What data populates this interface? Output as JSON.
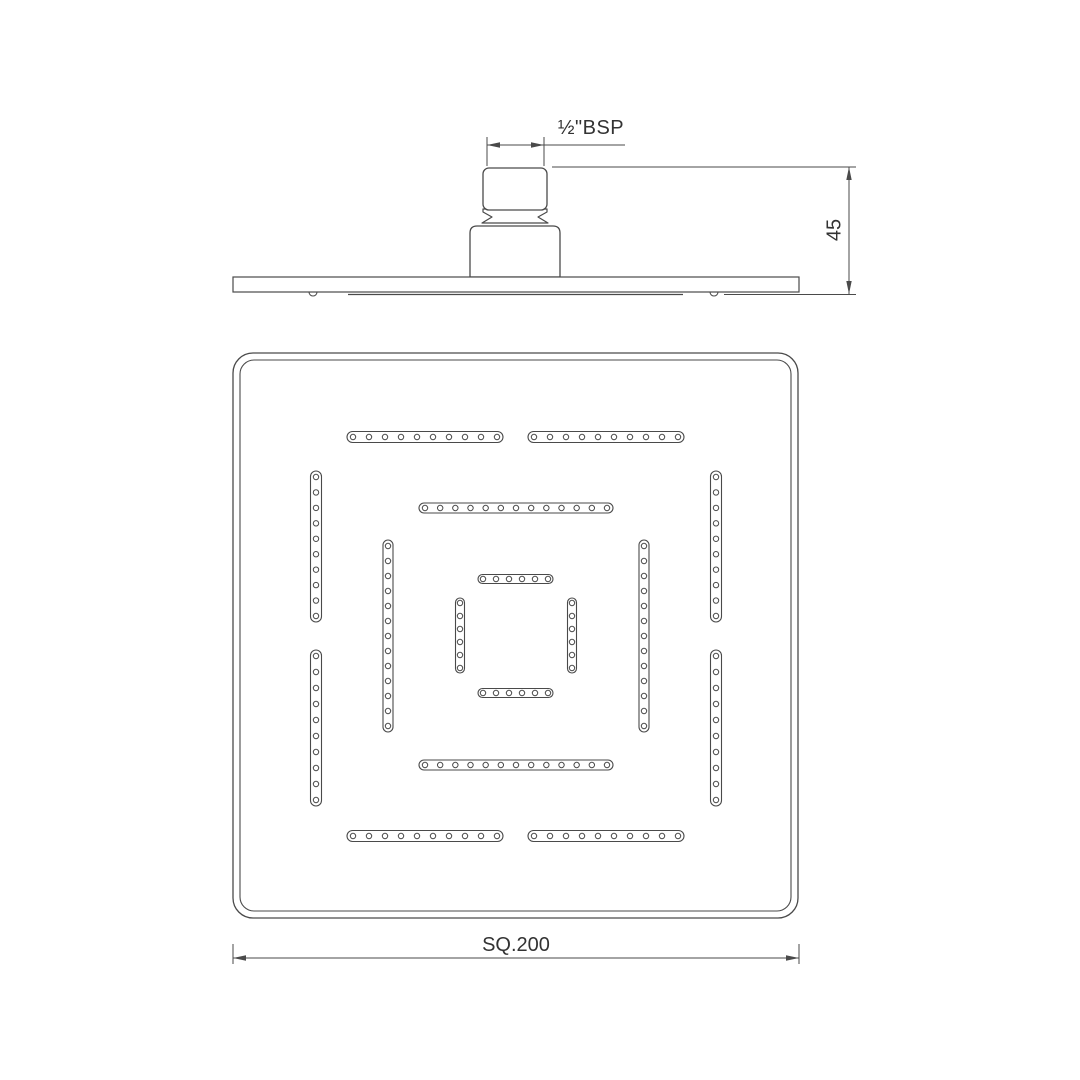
{
  "labels": {
    "thread_size": "½\"BSP",
    "head_height": "45",
    "head_size": "SQ.200"
  },
  "drawing": {
    "line_color": "#4a4a4a",
    "background": "#ffffff",
    "bottom_view": {
      "outer": {
        "x": 233,
        "y": 353,
        "size": 565,
        "r": 20
      },
      "inner": {
        "x": 240,
        "y": 360,
        "size": 551,
        "r": 14
      }
    },
    "slots": [
      {
        "t": "h",
        "a1": 347,
        "a2": 503,
        "c": 437,
        "w": 11,
        "n": 10
      },
      {
        "t": "h",
        "a1": 528,
        "a2": 684,
        "c": 437,
        "w": 11,
        "n": 10
      },
      {
        "t": "h",
        "a1": 347,
        "a2": 503,
        "c": 836,
        "w": 11,
        "n": 10
      },
      {
        "t": "h",
        "a1": 528,
        "a2": 684,
        "c": 836,
        "w": 11,
        "n": 10
      },
      {
        "t": "v",
        "a1": 471,
        "a2": 622,
        "c": 316,
        "w": 11,
        "n": 10
      },
      {
        "t": "v",
        "a1": 650,
        "a2": 806,
        "c": 316,
        "w": 11,
        "n": 10
      },
      {
        "t": "v",
        "a1": 471,
        "a2": 622,
        "c": 716,
        "w": 11,
        "n": 10
      },
      {
        "t": "v",
        "a1": 650,
        "a2": 806,
        "c": 716,
        "w": 11,
        "n": 10
      },
      {
        "t": "h",
        "a1": 419,
        "a2": 613,
        "c": 508,
        "w": 10,
        "n": 13
      },
      {
        "t": "h",
        "a1": 419,
        "a2": 613,
        "c": 765,
        "w": 10,
        "n": 13
      },
      {
        "t": "v",
        "a1": 540,
        "a2": 732,
        "c": 388,
        "w": 10,
        "n": 13
      },
      {
        "t": "v",
        "a1": 540,
        "a2": 732,
        "c": 644,
        "w": 10,
        "n": 13
      },
      {
        "t": "h",
        "a1": 478,
        "a2": 553,
        "c": 579,
        "w": 9,
        "n": 6
      },
      {
        "t": "h",
        "a1": 478,
        "a2": 553,
        "c": 693,
        "w": 9,
        "n": 6
      },
      {
        "t": "v",
        "a1": 598,
        "a2": 673,
        "c": 460,
        "w": 9,
        "n": 6
      },
      {
        "t": "v",
        "a1": 598,
        "a2": 673,
        "c": 572,
        "w": 9,
        "n": 6
      }
    ],
    "side_view": {
      "plate": {
        "x1": 233,
        "x2": 799,
        "y1": 277,
        "y2": 292
      },
      "face_y": 294.5,
      "face_segments": [
        [
          348,
          683
        ]
      ],
      "bumps": [
        313,
        714
      ],
      "bump_r": 4,
      "nipple": {
        "x": 483,
        "y": 168,
        "w": 64,
        "h": 42,
        "r": 6
      },
      "waist_path": "M483 209 H547 V212 L538 217 L548 223 H482 L492 217 L483 212 Z",
      "base_path": "M470 277 V233 Q470 226 477 226 H553 Q560 226 560 233 V277 Z"
    },
    "dims": {
      "bsp": {
        "ext": [
          [
            487,
            137,
            487,
            166
          ],
          [
            544,
            137,
            544,
            166
          ]
        ],
        "line": [
          487,
          145,
          625,
          145
        ],
        "arrows": [
          [
            487,
            145,
            "l"
          ],
          [
            544,
            145,
            "r"
          ]
        ]
      },
      "h45": {
        "ext": [
          [
            552,
            167,
            856,
            167
          ],
          [
            724,
            294.5,
            856,
            294.5
          ]
        ],
        "line": [
          849,
          167,
          849,
          294
        ],
        "arrows": [
          [
            849,
            167,
            "u"
          ],
          [
            849,
            294,
            "d"
          ]
        ]
      },
      "sq": {
        "ext": [
          [
            233,
            944,
            233,
            964
          ],
          [
            799,
            944,
            799,
            964
          ]
        ],
        "line": [
          233,
          958,
          799,
          958
        ],
        "arrows": [
          [
            233,
            958,
            "l"
          ],
          [
            799,
            958,
            "r"
          ]
        ]
      }
    }
  }
}
